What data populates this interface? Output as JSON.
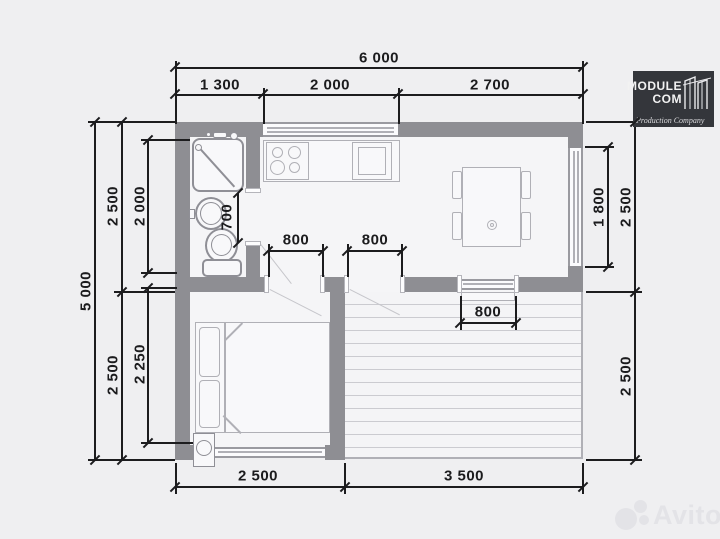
{
  "colors": {
    "background": "#efeff1",
    "wall": "#8e8e93",
    "dimension_line": "#1c1c1e",
    "room_fill": "#f5f5f7",
    "deck_plank": "#cbcbd0",
    "fixture_stroke": "#8f8f96",
    "logo_background": "#34363b",
    "logo_text": "#f2f2f2",
    "watermark": "#e3e3e7"
  },
  "dims": {
    "top_total": "6 000",
    "top_seg1": "1 300",
    "top_seg2": "2 000",
    "top_seg3": "2 700",
    "left_total": "5 000",
    "left_top": "2 500",
    "left_bottom": "2 500",
    "left_inner_top": "2 000",
    "left_inner_bottom": "2 250",
    "right_window": "1 800",
    "right_top": "2 500",
    "right_bottom": "2 500",
    "bottom_left": "2 500",
    "bottom_right": "3 500",
    "bath_door": "700",
    "door1": "800",
    "door2": "800",
    "terrace_door": "800"
  },
  "logo": {
    "name_line1": "MODULE",
    "name_line2": "COM",
    "tagline": "Production Company"
  },
  "watermark": {
    "text": "Avito"
  }
}
